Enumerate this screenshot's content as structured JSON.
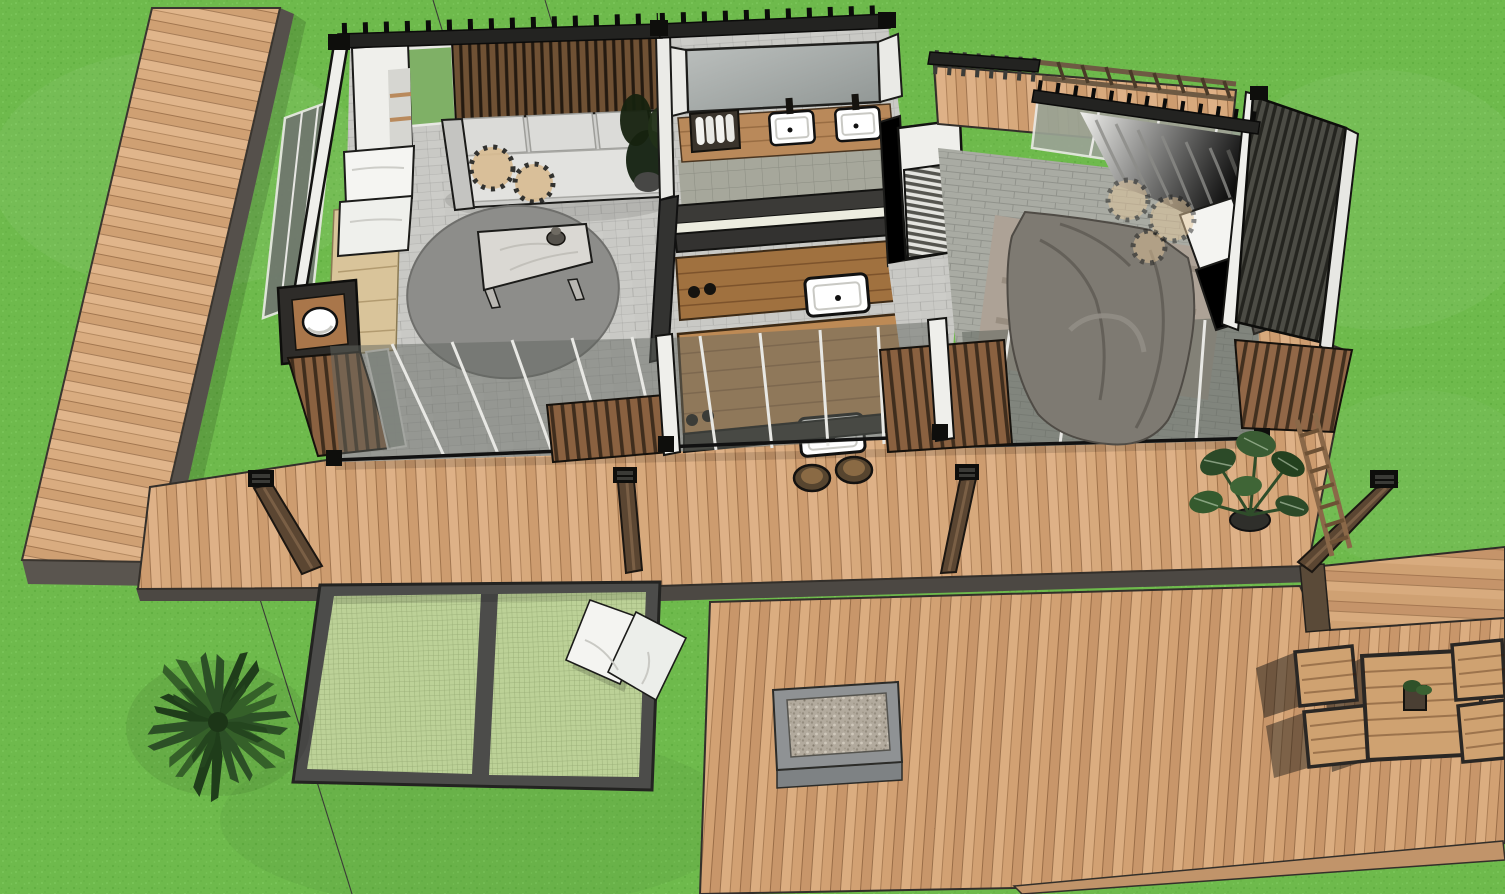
{
  "scene": {
    "title": "Aerial 3D cutaway rendering of a modern container-style tiny house with wooden decks, suspended net lounge and outdoor dining area on a grass lawn",
    "style": "SketchUp-like architectural render",
    "view": "bird's-eye section view"
  },
  "environment": {
    "ground": "grass lawn",
    "features": [
      "palm tree",
      "monstera plant in pot",
      "thin survey section lines"
    ]
  },
  "structures": {
    "boardwalk": {
      "label": "Side boardwalk path",
      "material": "light wood planks",
      "edge": "dark fascia"
    },
    "front_deck": {
      "label": "Front deck walkway",
      "material": "light wood planks",
      "pergola_posts": 4
    },
    "net_lounge": {
      "label": "Suspended net lounge",
      "panels": 2,
      "pillows": 2,
      "frame": "dark steel"
    },
    "lower_deck": {
      "label": "Lower entertainment deck",
      "features": [
        "gravel fire-pit inset",
        "outdoor dining set"
      ]
    },
    "deck_arm": {
      "label": "Deck extension to the right"
    },
    "dining_set": {
      "table": "square slat-top wood table",
      "chairs": 4,
      "centerpiece": "potted plant"
    },
    "trellis": {
      "label": "Wood ladder trellis"
    }
  },
  "house": {
    "label": "Main house (roof cut away)",
    "rooms": [
      {
        "name": "Living room",
        "items": [
          "slatted accent wall",
          "3-seat gray sofa",
          "2 rattan poufs",
          "rattan pendant lamp",
          "round gray rug",
          "marble coffee table with vase",
          "corner plant",
          "day bed with 2 white pillows",
          "entry washbasin nook",
          "tile floor"
        ]
      },
      {
        "name": "Bathroom",
        "items": [
          "wide wall mirror",
          "double vanity",
          "2 white vessel sinks",
          "towel basket",
          "gray tile floor"
        ]
      },
      {
        "name": "Kitchen",
        "items": [
          "back counter with sink",
          "island with cooktop knobs and sink",
          "2 rattan bar stools"
        ]
      },
      {
        "name": "Hallway",
        "items": [
          "louvered wardrobe"
        ]
      },
      {
        "name": "Bedroom",
        "items": [
          "double bed with dark gray duvet",
          "2 white pillows",
          "mottled area rug",
          "3 rattan pendant lamps",
          "flowing curtains",
          "dark louvered privacy screen"
        ]
      },
      {
        "name": "Rear balcony",
        "items": [
          "wood deck",
          "slat railing",
          "pergola beams"
        ]
      }
    ],
    "glazing": "full-width sliding glass doors along the front",
    "screens": "vertical wood slat privacy screens between doors"
  },
  "colors": {
    "grass": "#6eba4c",
    "deck_wood": "#d7a97c",
    "boardwalk_wood": "#d9ac80",
    "dark_fascia": "#4c4843",
    "charcoal_wall": "#2a2a27",
    "white_wall": "#efefeb",
    "tile_floor": "#c9c9c5",
    "bath_tile": "#a6a79b",
    "bedroom_tile": "#a9aba3",
    "rug_gray": "#8d8d8a",
    "sofa_gray": "#d5d5d2",
    "duvet_gray": "#7e7a72",
    "pillow_white": "#f4f4f1",
    "net_mesh": "#bcd197",
    "accent_slats": "#6f5134",
    "exterior_slats": "#8a6140",
    "rattan": "#cfa874",
    "marble": "#dad8d3",
    "plant_green": "#2f4d2c",
    "glass": "#70766f"
  }
}
